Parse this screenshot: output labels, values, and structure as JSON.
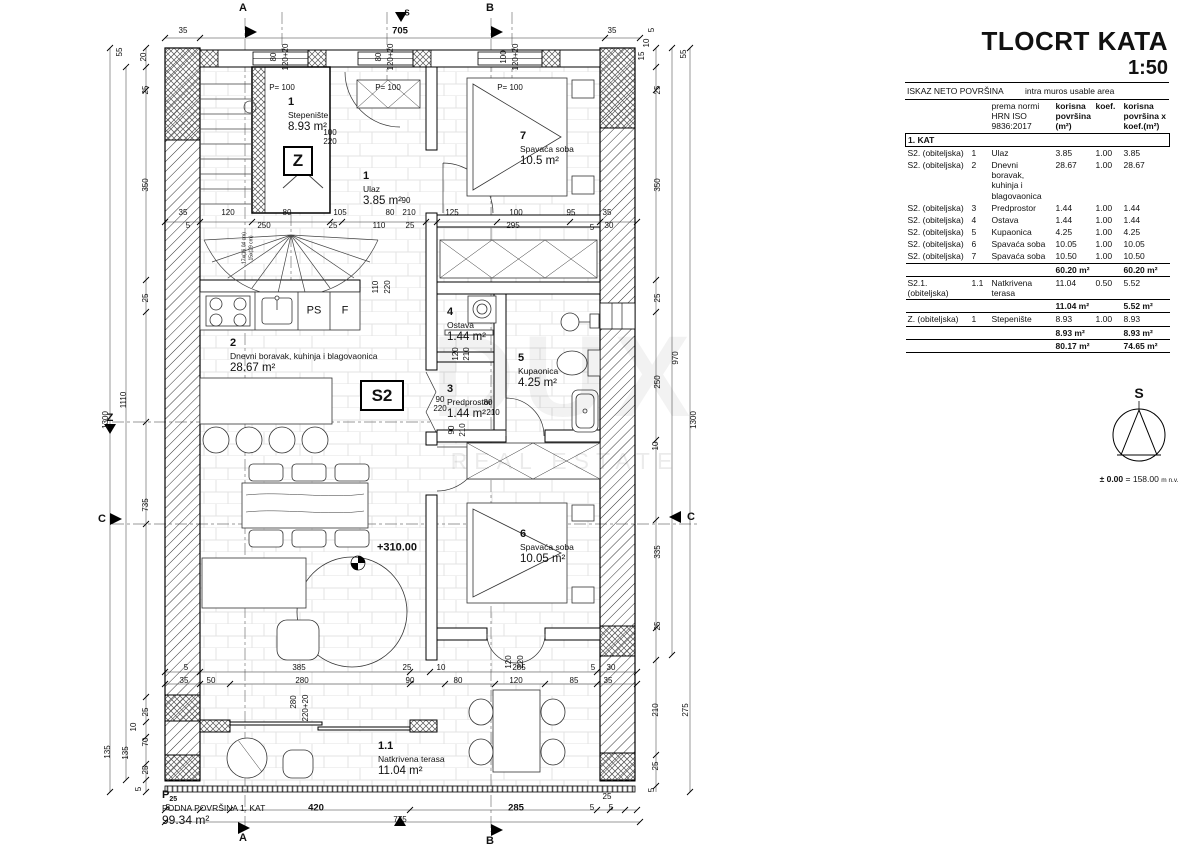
{
  "title": {
    "main": "TLOCRT KATA",
    "scale": "1:50"
  },
  "table": {
    "title_left": "ISKAZ NETO POVRŠINA",
    "title_right": "intra muros usable area",
    "col_norm": "prema normi\nHRN ISO\n9836:2017",
    "col_area": "korisna\npovršina\n(m²)",
    "col_koef": "koef.",
    "col_result": "korisna\npovršina  x\nkoef.(m²)",
    "section": "1. KAT",
    "groups": [
      {
        "rows": [
          {
            "unit": "S2. (obiteljska)",
            "no": "1",
            "name": "Ulaz",
            "area": "3.85",
            "koef": "1.00",
            "result": "3.85"
          },
          {
            "unit": "S2. (obiteljska)",
            "no": "2",
            "name": "Dnevni boravak, kuhinja i blagovaonica",
            "area": "28.67",
            "koef": "1.00",
            "result": "28.67"
          },
          {
            "unit": "S2. (obiteljska)",
            "no": "3",
            "name": "Predprostor",
            "area": "1.44",
            "koef": "1.00",
            "result": "1.44"
          },
          {
            "unit": "S2. (obiteljska)",
            "no": "4",
            "name": "Ostava",
            "area": "1.44",
            "koef": "1.00",
            "result": "1.44"
          },
          {
            "unit": "S2. (obiteljska)",
            "no": "5",
            "name": "Kupaonica",
            "area": "4.25",
            "koef": "1.00",
            "result": "4.25"
          },
          {
            "unit": "S2. (obiteljska)",
            "no": "6",
            "name": "Spavaća soba",
            "area": "10.05",
            "koef": "1.00",
            "result": "10.05"
          },
          {
            "unit": "S2. (obiteljska)",
            "no": "7",
            "name": "Spavaća soba",
            "area": "10.50",
            "koef": "1.00",
            "result": "10.50"
          }
        ],
        "subtotal_area": "60.20 m²",
        "subtotal_result": "60.20 m²"
      },
      {
        "rows": [
          {
            "unit": "S2.1. (obiteljska)",
            "no": "1.1",
            "name": "Natkrivena terasa",
            "area": "11.04",
            "koef": "0.50",
            "result": "5.52"
          }
        ],
        "subtotal_area": "11.04 m²",
        "subtotal_result": "5.52 m²"
      },
      {
        "rows": [
          {
            "unit": "Z. (obiteljska)",
            "no": "1",
            "name": "Stepenište",
            "area": "8.93",
            "koef": "1.00",
            "result": "8.93"
          }
        ],
        "subtotal_area": "8.93 m²",
        "subtotal_result": "8.93 m²"
      }
    ],
    "total_area": "80.17 m²",
    "total_result": "74.65 m²"
  },
  "north": {
    "label": "S",
    "elev_bold": "± 0.00",
    "elev_rest": "= 158.00",
    "elev_unit": "m n.v."
  },
  "watermark": {
    "logo": "DUX",
    "text": "REAL ESTATE"
  },
  "plan": {
    "box_z": "Z",
    "box_s2": "S2",
    "bottom_left": {
      "p": "P",
      "p_sub": "25",
      "line1": "PODNA POVRŠINA 1. KAT",
      "area": "99.34 m²"
    },
    "rooms": [
      {
        "num": "1",
        "name": "Stepenište",
        "area": "8.93 m²",
        "x": 288,
        "y": 96
      },
      {
        "num": "1",
        "name": "Ulaz",
        "area": "3.85 m²",
        "x": 363,
        "y": 170
      },
      {
        "num": "7",
        "name": "Spavaća soba",
        "area": "10.5 m²",
        "x": 520,
        "y": 130
      },
      {
        "num": "2",
        "name": "Dnevni boravak, kuhinja i blagovaonica",
        "area": "28.67 m²",
        "x": 230,
        "y": 337
      },
      {
        "num": "4",
        "name": "Ostava",
        "area": "1.44 m²",
        "x": 447,
        "y": 306
      },
      {
        "num": "5",
        "name": "Kupaonica",
        "area": "4.25 m²",
        "x": 518,
        "y": 352
      },
      {
        "num": "3",
        "name": "Predprostor",
        "area": "1.44 m²",
        "x": 447,
        "y": 383
      },
      {
        "num": "6",
        "name": "Spavaća soba",
        "area": "10.05 m²",
        "x": 520,
        "y": 528
      },
      {
        "num": "1.1",
        "name": "Natkrivena terasa",
        "area": "11.04 m²",
        "x": 378,
        "y": 740
      }
    ],
    "small_labels": [
      {
        "t": "P= 100",
        "x": 282,
        "y": 88
      },
      {
        "t": "P= 100",
        "x": 388,
        "y": 88
      },
      {
        "t": "P= 100",
        "x": 510,
        "y": 88
      },
      {
        "t": "PS",
        "x": 314,
        "y": 311,
        "s": 11
      },
      {
        "t": "F",
        "x": 345,
        "y": 311,
        "s": 11
      },
      {
        "t": "+310.00",
        "x": 397,
        "y": 548,
        "b": 1,
        "s": 11
      },
      {
        "t": "17x(16,04 cm)",
        "x": 245,
        "y": 248,
        "r": 1,
        "s": 5
      },
      {
        "t": "15x(29 cm)",
        "x": 252,
        "y": 248,
        "r": 1,
        "s": 5
      }
    ],
    "markers": [
      {
        "t": "A",
        "x": 243,
        "y": 8
      },
      {
        "t": "B",
        "x": 490,
        "y": 8
      },
      {
        "t": "S",
        "x": 407,
        "y": 13,
        "s": 8
      },
      {
        "t": "A",
        "x": 243,
        "y": 838
      },
      {
        "t": "B",
        "x": 490,
        "y": 841
      },
      {
        "t": "Z",
        "x": 110,
        "y": 418
      },
      {
        "t": "C",
        "x": 102,
        "y": 519
      },
      {
        "t": "C",
        "x": 691,
        "y": 517
      }
    ],
    "dims": [
      {
        "t": "35",
        "x": 183,
        "y": 31
      },
      {
        "t": "705",
        "x": 400,
        "y": 31,
        "b": 1
      },
      {
        "t": "35",
        "x": 612,
        "y": 31
      },
      {
        "t": "80",
        "x": 274,
        "y": 57,
        "r": 1
      },
      {
        "t": "120+20",
        "x": 286,
        "y": 57,
        "r": 1
      },
      {
        "t": "80",
        "x": 379,
        "y": 57,
        "r": 1
      },
      {
        "t": "120+20",
        "x": 391,
        "y": 57,
        "r": 1
      },
      {
        "t": "100",
        "x": 504,
        "y": 57,
        "r": 1
      },
      {
        "t": "120+20",
        "x": 516,
        "y": 57,
        "r": 1
      },
      {
        "t": "55",
        "x": 120,
        "y": 52,
        "r": 1
      },
      {
        "t": "20",
        "x": 144,
        "y": 57,
        "r": 1
      },
      {
        "t": "25",
        "x": 146,
        "y": 90,
        "r": 1
      },
      {
        "t": "350",
        "x": 146,
        "y": 185,
        "r": 1
      },
      {
        "t": "25",
        "x": 146,
        "y": 298,
        "r": 1
      },
      {
        "t": "1110",
        "x": 124,
        "y": 400,
        "r": 1
      },
      {
        "t": "1300",
        "x": 106,
        "y": 420,
        "r": 1
      },
      {
        "t": "735",
        "x": 146,
        "y": 505,
        "r": 1
      },
      {
        "t": "25",
        "x": 146,
        "y": 712,
        "r": 1
      },
      {
        "t": "10",
        "x": 134,
        "y": 727,
        "r": 1
      },
      {
        "t": "70",
        "x": 146,
        "y": 742,
        "r": 1
      },
      {
        "t": "135",
        "x": 126,
        "y": 753,
        "r": 1
      },
      {
        "t": "25",
        "x": 146,
        "y": 770,
        "r": 1
      },
      {
        "t": "5",
        "x": 139,
        "y": 789,
        "r": 1
      },
      {
        "t": "135",
        "x": 108,
        "y": 752,
        "r": 1
      },
      {
        "t": "5",
        "x": 652,
        "y": 30,
        "r": 1
      },
      {
        "t": "10",
        "x": 647,
        "y": 43,
        "r": 1
      },
      {
        "t": "15",
        "x": 642,
        "y": 56,
        "r": 1
      },
      {
        "t": "55",
        "x": 684,
        "y": 54,
        "r": 1
      },
      {
        "t": "25",
        "x": 658,
        "y": 90,
        "r": 1
      },
      {
        "t": "350",
        "x": 658,
        "y": 185,
        "r": 1
      },
      {
        "t": "25",
        "x": 658,
        "y": 298,
        "r": 1
      },
      {
        "t": "250",
        "x": 658,
        "y": 382,
        "r": 1
      },
      {
        "t": "970",
        "x": 676,
        "y": 358,
        "r": 1
      },
      {
        "t": "1300",
        "x": 694,
        "y": 420,
        "r": 1
      },
      {
        "t": "10",
        "x": 656,
        "y": 446,
        "r": 1
      },
      {
        "t": "335",
        "x": 658,
        "y": 552,
        "r": 1
      },
      {
        "t": "25",
        "x": 658,
        "y": 626,
        "r": 1
      },
      {
        "t": "210",
        "x": 656,
        "y": 710,
        "r": 1
      },
      {
        "t": "275",
        "x": 686,
        "y": 710,
        "r": 1
      },
      {
        "t": "25",
        "x": 656,
        "y": 766,
        "r": 1
      },
      {
        "t": "5",
        "x": 652,
        "y": 790,
        "r": 1
      },
      {
        "t": "35",
        "x": 183,
        "y": 213
      },
      {
        "t": "120",
        "x": 228,
        "y": 213
      },
      {
        "t": "80",
        "x": 287,
        "y": 213
      },
      {
        "t": "105",
        "x": 340,
        "y": 213
      },
      {
        "t": "80",
        "x": 390,
        "y": 213
      },
      {
        "t": "90",
        "x": 406,
        "y": 201
      },
      {
        "t": "210",
        "x": 409,
        "y": 213
      },
      {
        "t": "5",
        "x": 188,
        "y": 226
      },
      {
        "t": "250",
        "x": 264,
        "y": 226
      },
      {
        "t": "25",
        "x": 333,
        "y": 226
      },
      {
        "t": "110",
        "x": 379,
        "y": 226
      },
      {
        "t": "25",
        "x": 410,
        "y": 226
      },
      {
        "t": "125",
        "x": 452,
        "y": 213
      },
      {
        "t": "100",
        "x": 516,
        "y": 213
      },
      {
        "t": "95",
        "x": 571,
        "y": 213
      },
      {
        "t": "35",
        "x": 607,
        "y": 213
      },
      {
        "t": "295",
        "x": 513,
        "y": 226
      },
      {
        "t": "5",
        "x": 592,
        "y": 228
      },
      {
        "t": "30",
        "x": 609,
        "y": 226
      },
      {
        "t": "100",
        "x": 330,
        "y": 133
      },
      {
        "t": "220",
        "x": 330,
        "y": 142
      },
      {
        "t": "110",
        "x": 376,
        "y": 287,
        "r": 1
      },
      {
        "t": "220",
        "x": 388,
        "y": 287,
        "r": 1
      },
      {
        "t": "120",
        "x": 456,
        "y": 354,
        "r": 1
      },
      {
        "t": "210",
        "x": 467,
        "y": 354,
        "r": 1
      },
      {
        "t": "90",
        "x": 440,
        "y": 400
      },
      {
        "t": "220",
        "x": 440,
        "y": 409
      },
      {
        "t": "80",
        "x": 488,
        "y": 403
      },
      {
        "t": "210",
        "x": 493,
        "y": 413
      },
      {
        "t": "90",
        "x": 452,
        "y": 430,
        "r": 1
      },
      {
        "t": "210",
        "x": 463,
        "y": 430,
        "r": 1
      },
      {
        "t": "5",
        "x": 186,
        "y": 668
      },
      {
        "t": "385",
        "x": 299,
        "y": 668
      },
      {
        "t": "25",
        "x": 407,
        "y": 668
      },
      {
        "t": "10",
        "x": 441,
        "y": 668
      },
      {
        "t": "285",
        "x": 519,
        "y": 668
      },
      {
        "t": "5",
        "x": 593,
        "y": 668
      },
      {
        "t": "30",
        "x": 611,
        "y": 668
      },
      {
        "t": "35",
        "x": 184,
        "y": 681
      },
      {
        "t": "50",
        "x": 211,
        "y": 681
      },
      {
        "t": "280",
        "x": 302,
        "y": 681
      },
      {
        "t": "90",
        "x": 410,
        "y": 681
      },
      {
        "t": "80",
        "x": 458,
        "y": 681
      },
      {
        "t": "120",
        "x": 516,
        "y": 681
      },
      {
        "t": "85",
        "x": 574,
        "y": 681
      },
      {
        "t": "35",
        "x": 608,
        "y": 681
      },
      {
        "t": "280",
        "x": 294,
        "y": 702,
        "r": 1
      },
      {
        "t": "220+20",
        "x": 306,
        "y": 708,
        "r": 1
      },
      {
        "t": "120",
        "x": 509,
        "y": 662,
        "r": 1
      },
      {
        "t": "220",
        "x": 521,
        "y": 662,
        "r": 1
      },
      {
        "t": "5",
        "x": 168,
        "y": 808
      },
      {
        "t": "420",
        "x": 316,
        "y": 808,
        "b": 1
      },
      {
        "t": "285",
        "x": 516,
        "y": 808,
        "b": 1
      },
      {
        "t": "25",
        "x": 607,
        "y": 797
      },
      {
        "t": "5",
        "x": 592,
        "y": 808
      },
      {
        "t": "5",
        "x": 611,
        "y": 808
      },
      {
        "t": "775",
        "x": 400,
        "y": 820
      }
    ]
  }
}
